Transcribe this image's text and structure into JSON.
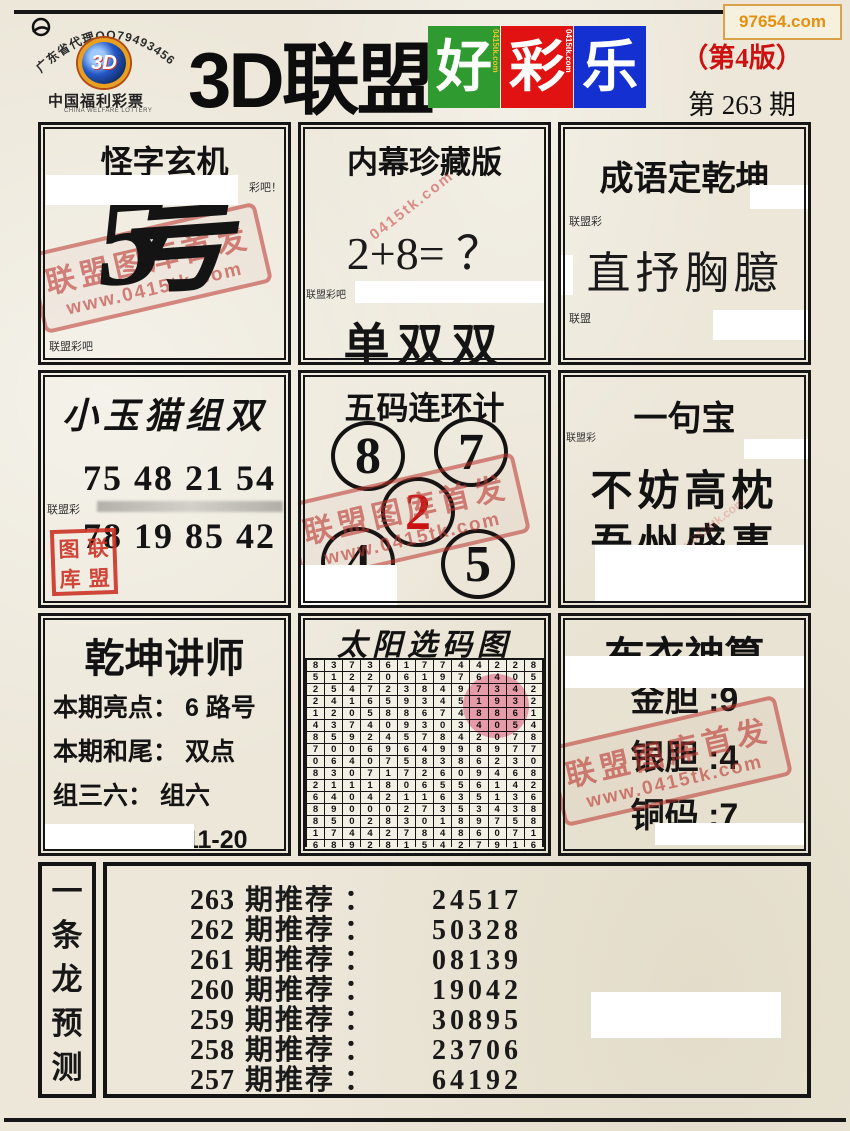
{
  "badge": {
    "text": "97654.com"
  },
  "header": {
    "arc_text": "广东省代理QQ79493456",
    "logo_text": "3D",
    "lottery_name": "中国福利彩票",
    "lottery_name_en": "CHINA WELFARE LOTTERY",
    "title_black": "3D联盟",
    "title_blocks": [
      {
        "char": "好",
        "bg": "#2f9a2f",
        "side_text": "0415tk.com",
        "side_color": "#eec32a"
      },
      {
        "char": "彩",
        "bg": "#e01212",
        "side_text": "0415tk.com",
        "side_color": "#ffffff"
      },
      {
        "char": "乐",
        "bg": "#1430d0",
        "side_text": "",
        "side_color": ""
      }
    ],
    "edition": "（第4版）",
    "issue": "第 263 期"
  },
  "stamp": {
    "line1": "联盟图库首发",
    "line2": "www.0415tk.com"
  },
  "panels": {
    "guaizi": {
      "title": "怪字玄机",
      "corner_note": "彩吧！",
      "mystery_glyph_part1": "5",
      "mystery_glyph_part2": "号",
      "note": "联盟彩吧"
    },
    "neimu": {
      "title": "内幕珍藏版",
      "watermark": "0415tk.com",
      "equation": "2+8= ？",
      "note": "联盟彩吧",
      "answer": "单双双"
    },
    "chengyu": {
      "title": "成语定乾坤",
      "note": "联盟彩",
      "idiom": "直抒胸臆",
      "note2": "联盟"
    },
    "xiaoyumao": {
      "title": "小玉猫组双",
      "row1": "75 48 21 54",
      "row2": "78 19 85 42",
      "note": "联盟彩",
      "seal_chars": [
        "图",
        "联",
        "库",
        "盟"
      ]
    },
    "wuma": {
      "title": "五码连环计",
      "numbers": [
        "8",
        "7",
        "2",
        "4",
        "5"
      ],
      "red_index": 2,
      "red_color": "#cc1111"
    },
    "yijubao": {
      "title": "一句宝",
      "note": "联盟彩",
      "line1": "不妨高枕",
      "line2": "吾州盛事"
    },
    "qiankun": {
      "title": "乾坤讲师",
      "lines": [
        {
          "label": "本期亮点：",
          "value": "6 路号"
        },
        {
          "label": "本期和尾：",
          "value": "双点"
        },
        {
          "label": "组三六：",
          "value": "组六"
        },
        {
          "label": "点数范围：",
          "value": "11-20"
        }
      ]
    },
    "taiyang": {
      "title": "太阳选码图",
      "rows": [
        "8373617744228",
        "5122061976405",
        "2547238497342",
        "2416593451932",
        "1205886748861",
        "4374093034054",
        "8592457842078",
        "7006964998977",
        "0640758386230",
        "8307172609468",
        "2111806556142",
        "6404211635136",
        "8900027353438",
        "8502830189758",
        "1744278486071",
        "6892815427916",
        "8373617744228"
      ]
    },
    "buyi": {
      "title": "布衣神算",
      "lines": [
        {
          "label": "金胆",
          "value": "9"
        },
        {
          "label": "银胆",
          "value": "4"
        },
        {
          "label": "铜码",
          "value": "7"
        }
      ]
    },
    "dragon": {
      "vertical_label": [
        "一",
        "条",
        "龙",
        "预",
        "测"
      ],
      "row_label": "期推荐 ：",
      "rows": [
        {
          "issue": "263",
          "value": "24517"
        },
        {
          "issue": "262",
          "value": "50328"
        },
        {
          "issue": "261",
          "value": "08139"
        },
        {
          "issue": "260",
          "value": "19042"
        },
        {
          "issue": "259",
          "value": "30895"
        },
        {
          "issue": "258",
          "value": "23706"
        },
        {
          "issue": "257",
          "value": "64192"
        }
      ]
    }
  }
}
